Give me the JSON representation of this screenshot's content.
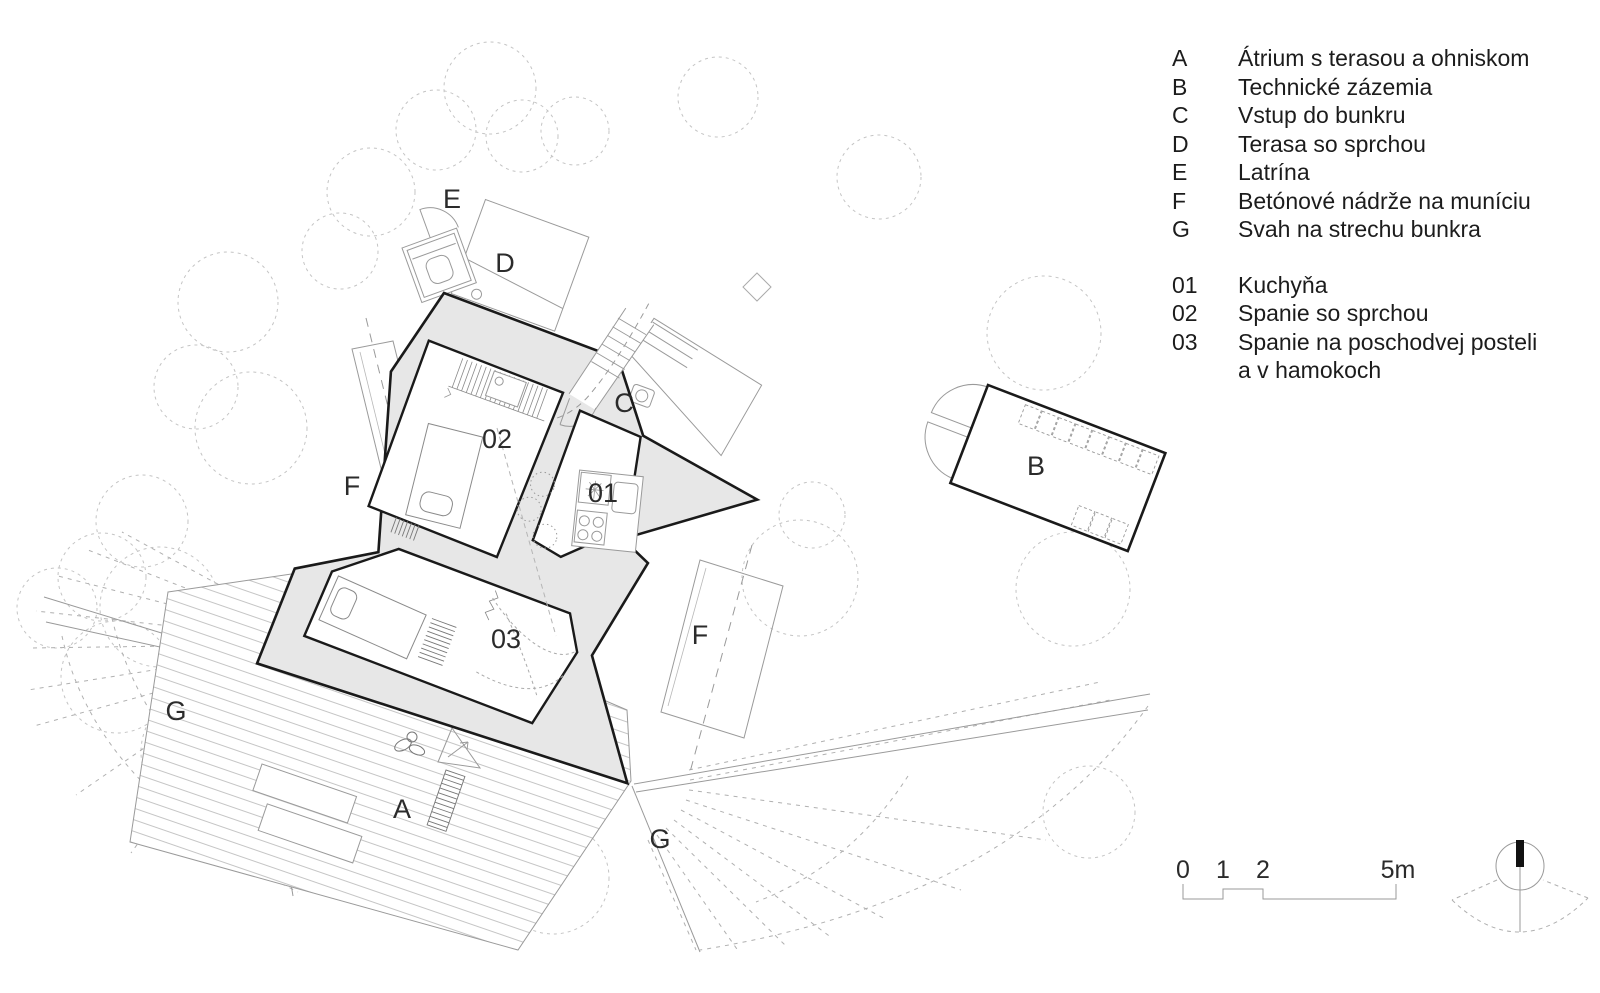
{
  "legend": {
    "areas": [
      {
        "key": "A",
        "label": "Átrium s terasou a ohniskom"
      },
      {
        "key": "B",
        "label": "Technické zázemia"
      },
      {
        "key": "C",
        "label": "Vstup do bunkru"
      },
      {
        "key": "D",
        "label": "Terasa so sprchou"
      },
      {
        "key": "E",
        "label": "Latrína"
      },
      {
        "key": "F",
        "label": "Betónové nádrže na muníciu"
      },
      {
        "key": "G",
        "label": "Svah na strechu bunkra"
      }
    ],
    "rooms": [
      {
        "key": "01",
        "label": "Kuchyňa"
      },
      {
        "key": "02",
        "label": "Spanie so sprchou"
      },
      {
        "key": "03",
        "label": "Spanie na poschodvej posteli",
        "label2": "a v hamokoch"
      }
    ]
  },
  "plan": {
    "labels": {
      "A": "A",
      "B": "B",
      "C": "C",
      "D": "D",
      "E": "E",
      "F": "F",
      "G": "G",
      "r01": "01",
      "r02": "02",
      "r03": "03"
    }
  },
  "scale": {
    "ticks": [
      "0",
      "1",
      "2",
      "5m"
    ]
  },
  "colors": {
    "wall_fill": "#e7e7e7",
    "wall_line": "#1a1a1a",
    "thin_line": "#9a9a9a",
    "tree_line": "#c4c4c4"
  }
}
